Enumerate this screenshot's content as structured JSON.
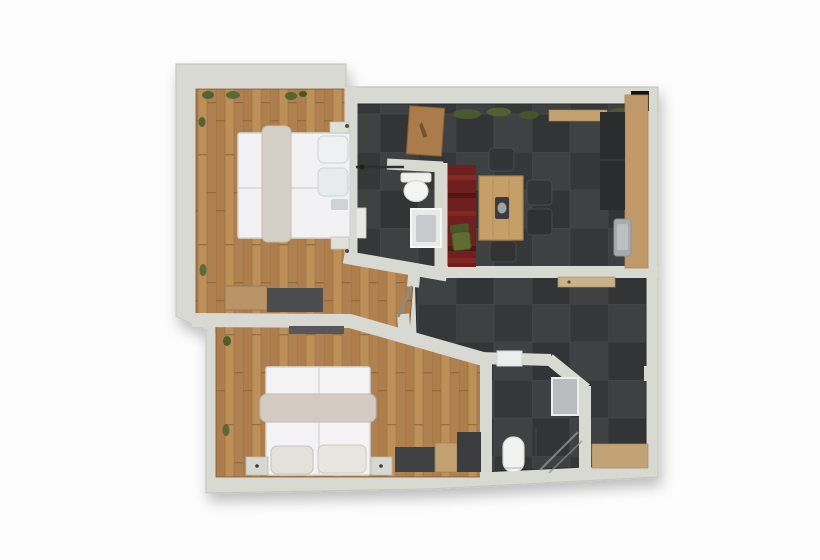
{
  "image": {
    "kind": "3d-rendered floor plan, top-down view",
    "background_color": "#fdfdfd",
    "no_visible_text": true
  },
  "palette": {
    "bg": "#fdfdfd",
    "wall": "#d9d9d3",
    "wall-edge": "#c6c7c0",
    "wood": "#b58753",
    "tile": "#37393b",
    "rug": "#6e1f1e",
    "green": "#52642f",
    "counter": "#bf9a68",
    "fixture": "#f2f3f1",
    "dark-furn": "#3c3e40"
  },
  "rooms": [
    {
      "name": "Bedroom 1 (top left)",
      "floor": "wood planks",
      "furniture": [
        "double bed with white duvet and beige runner blanket",
        "two pillows at right headboard",
        "two nightstands",
        "wood and dark sideboard at south wall",
        "green plants along walls"
      ]
    },
    {
      "name": "Bathroom 1 (top middle)",
      "floor": "dark tile",
      "furniture": [
        "wall toilet facing down",
        "shower with glass screen",
        "white shower tray with grey base",
        "small white shelf",
        "wooden entry mat in top nook"
      ]
    },
    {
      "name": "Kitchen / dining (top right)",
      "floor": "dark tile",
      "furniture": [
        "wooden dining table with dark centerpiece and bowl",
        "dark chair north",
        "two dark chairs east",
        "dark chair south",
        "green chair west",
        "red runner rug",
        "wooden counter along right wall",
        "grey sink",
        "dark appliance block",
        "upper cabinet strip",
        "black chimney square in wall corner",
        "green plants along top wall"
      ]
    },
    {
      "name": "Hallway (middle right)",
      "floor": "dark tile",
      "furniture": [
        "wooden bench under kitchen wall",
        "wooden doormat bottom right",
        "small wall nub on right wall",
        "open door leaf into hall"
      ]
    },
    {
      "name": "Bedroom 2 (bottom left)",
      "floor": "wood planks",
      "furniture": [
        "double bed with white duvet and beige blanket band",
        "two beige pillows at bottom headboard",
        "two nightstands",
        "dark bench",
        "wooden cabinet",
        "dark dresser",
        "wall-mounted TV strip on dividing wall"
      ]
    },
    {
      "name": "Bathroom 2 (bottom middle)",
      "floor": "dark tile",
      "furniture": [
        "wall sink at top",
        "grey shower tray right",
        "toilet facing up bottom left",
        "corner shower with glass diagonals and pole"
      ]
    }
  ]
}
